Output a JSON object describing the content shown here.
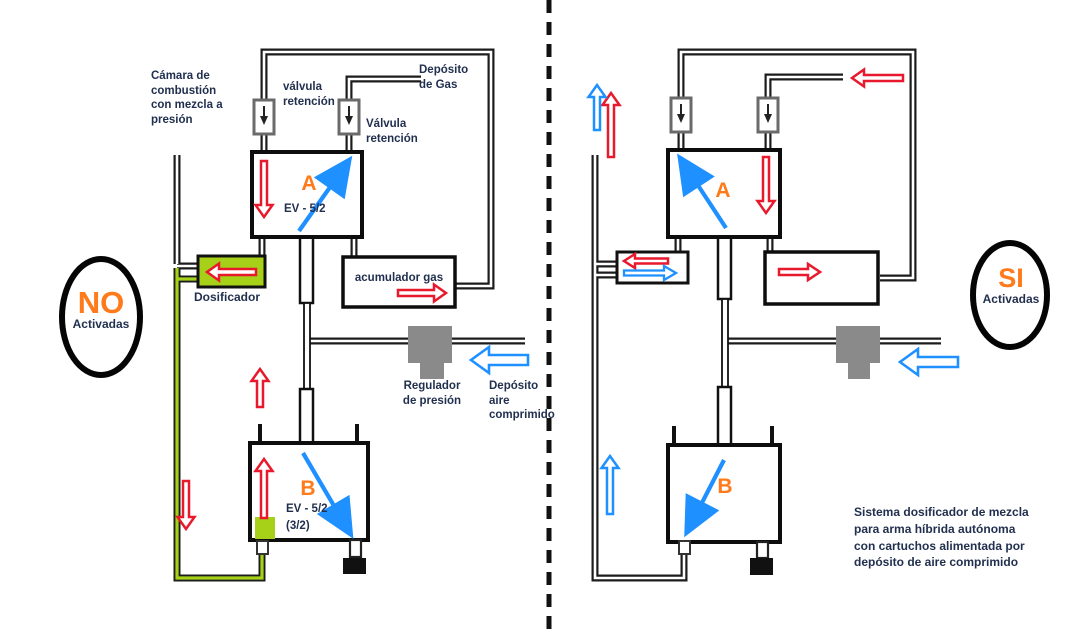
{
  "left_diagram": {
    "chamber_label": "Cámara de\ncombustión\ncon mezcla a\npresión",
    "check_valve_label_1": "válvula\nretención",
    "gas_tank_label": "Depósito\nde Gas",
    "check_valve_label_2": "Válvula\nretención",
    "valve_a": {
      "letter": "A",
      "type": "EV - 5/2"
    },
    "valve_b": {
      "letter": "B",
      "type": "EV - 5/2",
      "subtype": "(3/2)"
    },
    "accumulator_label": "acumulador gas",
    "doser_label": "Dosificador",
    "regulator_label": "Regulador\nde presión",
    "air_tank_label": "Depósito\naire\ncomprimido",
    "status_oval": {
      "main": "NO",
      "sub": "Activadas"
    }
  },
  "right_diagram": {
    "valve_a": {
      "letter": "A"
    },
    "valve_b": {
      "letter": "B"
    },
    "status_oval": {
      "main": "SI",
      "sub": "Activadas"
    },
    "caption": "Sistema dosificador de mezcla\npara arma híbrida autónoma\ncon cartuchos alimentada por\ndepósito de aire comprimido"
  },
  "colors": {
    "highlight_green": "#a6d118",
    "accent_orange": "#ff7a1a",
    "label_navy": "#22304f",
    "red_arrow": "#e8192c",
    "blue_arrow": "#1e90ff",
    "regulator_gray": "#8a8a8a",
    "pipe_dark": "#1c1c1c"
  }
}
